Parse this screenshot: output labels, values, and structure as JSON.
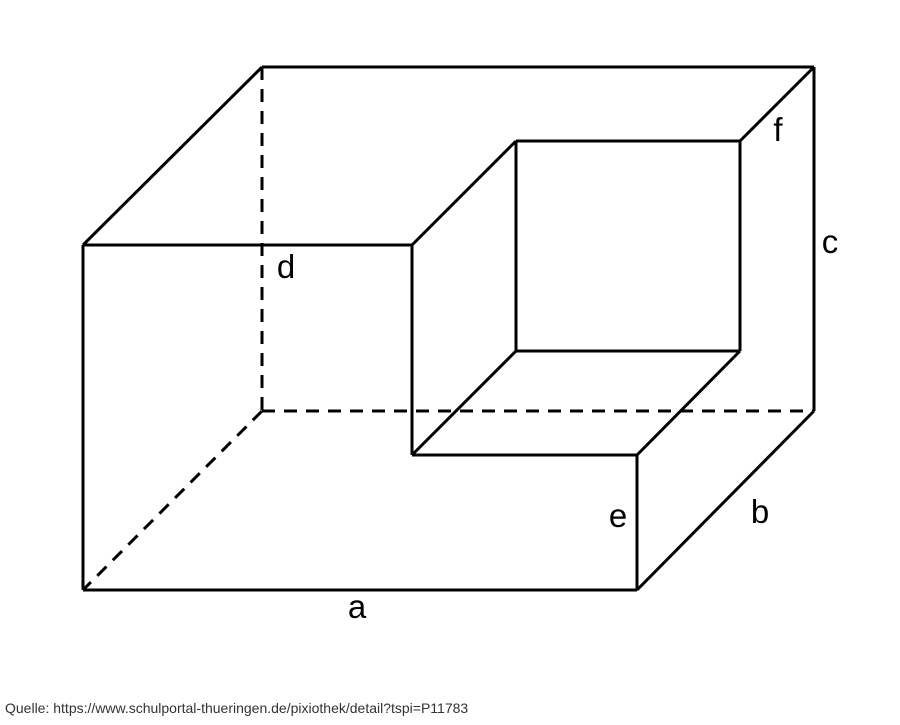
{
  "figure": {
    "kind": "geometric-solid-diagram",
    "stroke_color": "#000000",
    "background_color": "#ffffff",
    "labels": {
      "a": "a",
      "b": "b",
      "c": "c",
      "d": "d",
      "e": "e",
      "f": "f"
    }
  },
  "source": {
    "text": "Quelle: https://www.schulportal-thueringen.de/pixiothek/detail?tspi=P11783",
    "color": "#333333"
  }
}
